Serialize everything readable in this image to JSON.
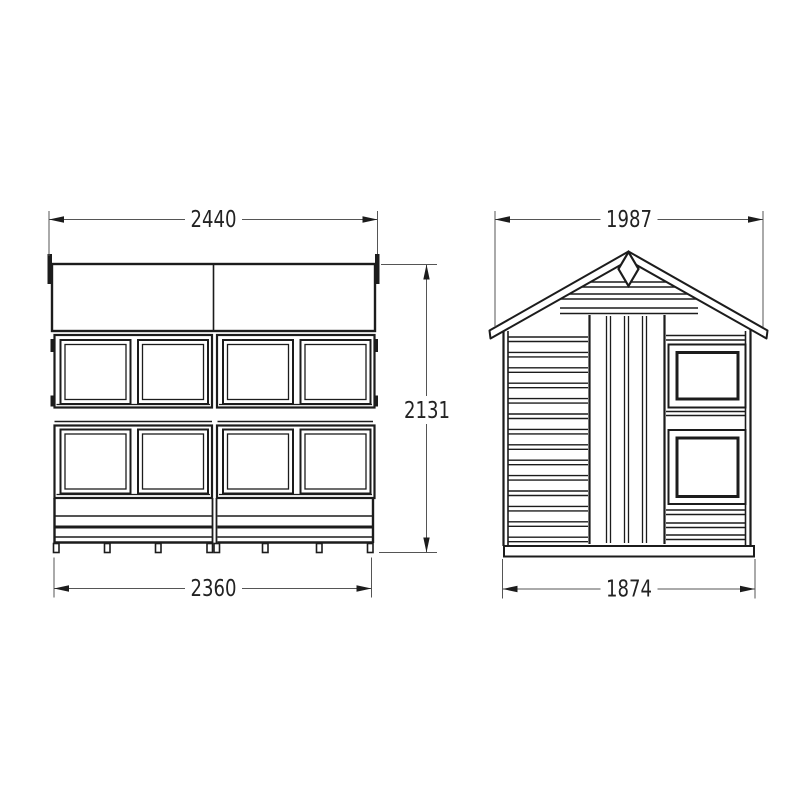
{
  "title": "shed-technical-drawing",
  "colors": {
    "background": "#ffffff",
    "line": "#1c1c1c",
    "dimension_line": "#555555",
    "text": "#222222"
  },
  "views": {
    "front_elevation": {
      "name": "front elevation",
      "dimensions": {
        "overall_width_mm": "2440",
        "base_width_mm": "2360",
        "height_mm": "2131"
      }
    },
    "gable_end_elevation": {
      "name": "gable end elevation",
      "dimensions": {
        "overall_width_mm": "1987",
        "base_width_mm": "1874"
      }
    }
  }
}
